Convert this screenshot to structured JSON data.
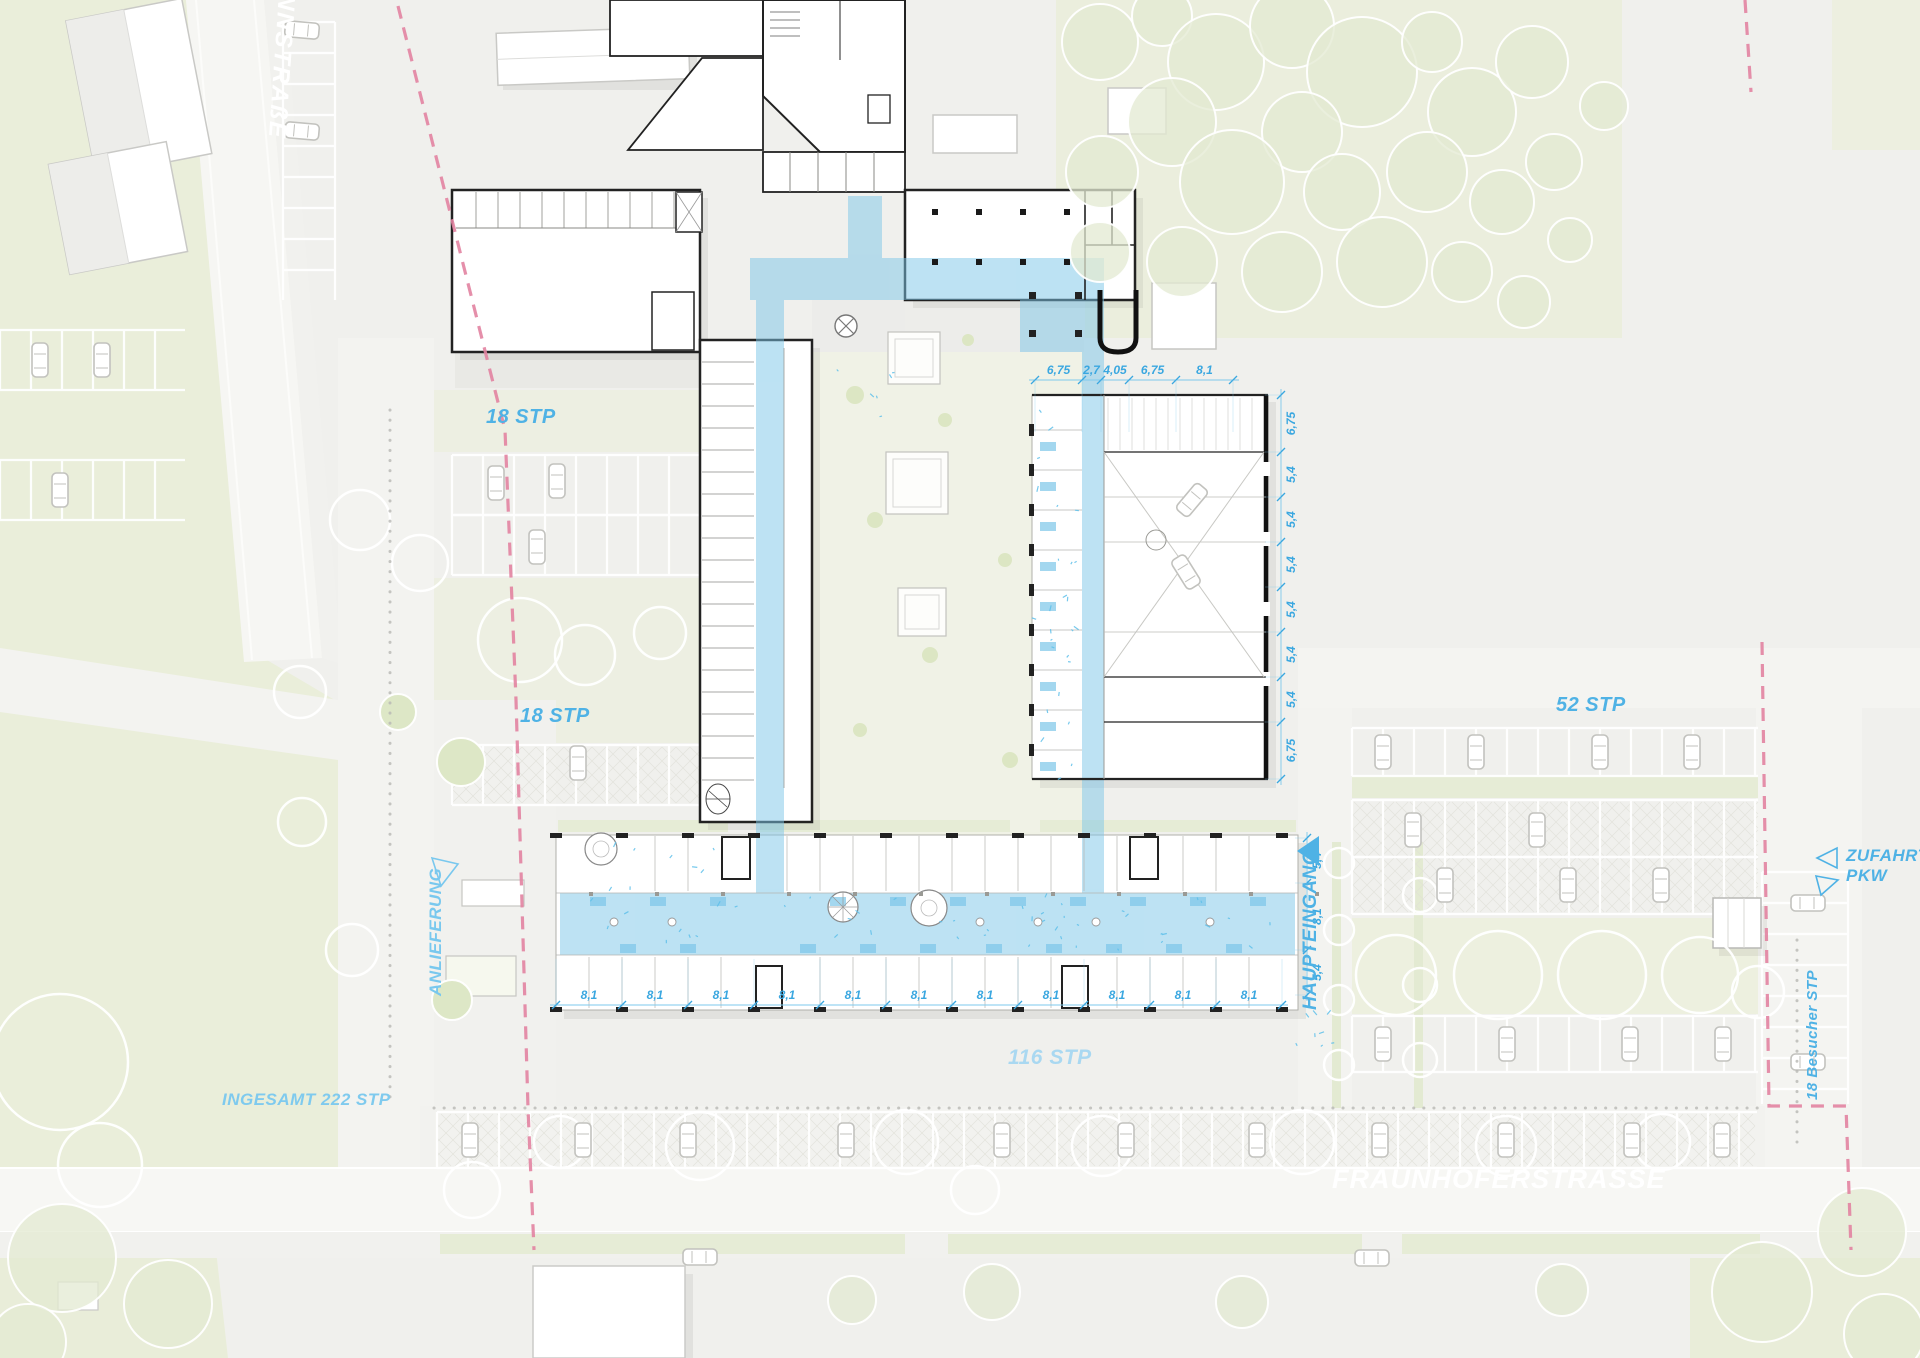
{
  "streets": {
    "left_street": "NNSTRAßE",
    "main_street": "FRAUNHOFERSTRASSE"
  },
  "labels": {
    "parking_small_1": "18 STP",
    "parking_small_2": "18 STP",
    "parking_52": "52 STP",
    "parking_116": "116 STP",
    "parking_total": "INGESAMT 222 STP",
    "visitor_parking": "18 Besucher STP",
    "delivery": "ANLIEFERUNG",
    "main_entrance": "HAUPTEINGANG",
    "access_line1": "ZUFAHRT",
    "access_line2": "PKW"
  },
  "dimensions": {
    "wing_top": {
      "values": [
        "6,75",
        "2,7",
        "4,05",
        "6,75",
        "8,1"
      ]
    },
    "wing_right": {
      "values": [
        "6,75",
        "5,4",
        "5,4",
        "5,4",
        "5,4",
        "5,4",
        "5,4",
        "6,75"
      ]
    },
    "south_bottom": {
      "values": [
        "8,1",
        "8,1",
        "8,1",
        "8,1",
        "8,1",
        "8,1",
        "8,1",
        "8,1",
        "8,1",
        "8,1",
        "8,1"
      ]
    },
    "south_right": {
      "values": [
        "5,4",
        "8,1",
        "5,4"
      ]
    }
  },
  "colors": {
    "accent_blue": "#4fb2e5",
    "dim_blue": "#3aa7e0",
    "light_label_blue": "#a9d8f1",
    "medium_label_blue": "#7fcaee",
    "circulation_fill": "#7cc6e8",
    "boundary_pink": "#e283a1",
    "grass_green": "#eaeeda",
    "linework": "#222222",
    "street_text": "#ffffff"
  }
}
